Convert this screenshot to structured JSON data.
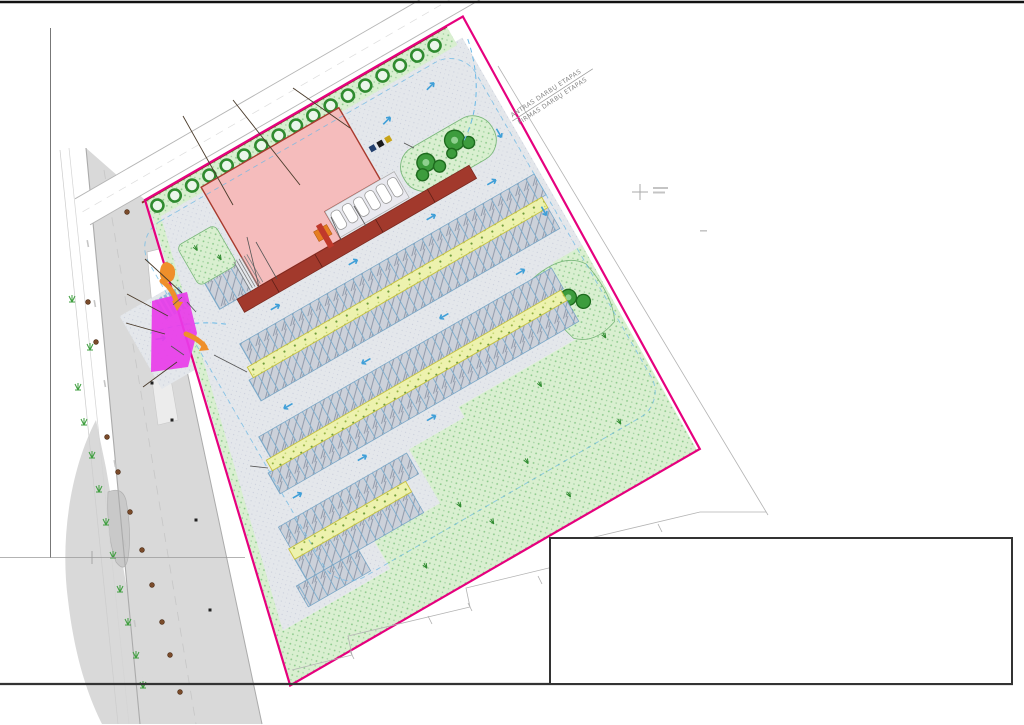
{
  "drawing": {
    "kind": "parking-lot site plan",
    "stage_boundary": {
      "line1": "ANTRAS DARBŲ ETAPAS",
      "line2": "PIRMAS DARBŲ ETAPAS"
    }
  },
  "colors": {
    "boundary": "#e6007e",
    "magenta_area": "#e93ce9",
    "building": "#f5bcbc",
    "building_stroke": "#a83a2e",
    "walkway": "#a2392c",
    "paving": "#e4e7eb",
    "green": "#d9efd0",
    "yellow_strip": "#edf2ae",
    "arrow_orange": "#ef8f2a",
    "flow_blue": "#3f9fd8",
    "sign_red": "#8b1616",
    "sign_blue": "#1a56c0",
    "tree_green": "#3d9c3d"
  },
  "parking_letter": "P",
  "sign_columns": [
    {
      "x": 183,
      "y": 38,
      "items": [
        {
          "kind": "parking",
          "code": "828"
        },
        {
          "kind": "car",
          "code": "836"
        },
        {
          "kind": "arrows",
          "code": "814"
        }
      ]
    },
    {
      "x": 233,
      "y": 24,
      "items": [
        {
          "kind": "parking",
          "code": "828"
        },
        {
          "kind": "accessible",
          "code": "846"
        },
        {
          "kind": "arrows",
          "code": "814"
        }
      ]
    },
    {
      "x": 293,
      "y": 28,
      "items": [
        {
          "kind": "code",
          "code": "828"
        },
        {
          "kind": "car",
          "code": "854"
        },
        {
          "kind": "arrows",
          "code": "814"
        }
      ]
    }
  ],
  "left_signs": [
    {
      "kind": "crossing",
      "code": "533",
      "x": 136,
      "y": 249
    },
    {
      "kind": "yield",
      "code": "",
      "x": 116,
      "y": 282
    },
    {
      "kind": "crossing",
      "code": "533",
      "x": 117,
      "y": 313
    },
    {
      "kind": "crossing",
      "code": "533",
      "x": 135,
      "y": 381
    }
  ],
  "callouts": [
    {
      "n": "10",
      "x": 303,
      "y": 171
    },
    {
      "n": "1",
      "x": 395,
      "y": 258
    },
    {
      "n": "2",
      "x": 432,
      "y": 371
    },
    {
      "n": "3",
      "x": 277,
      "y": 279
    },
    {
      "n": "8",
      "x": 259,
      "y": 287
    },
    {
      "n": "4",
      "x": 341,
      "y": 240
    },
    {
      "n": "5",
      "x": 366,
      "y": 226
    },
    {
      "n": "6",
      "x": 404,
      "y": 143
    },
    {
      "n": "9",
      "x": 207,
      "y": 258
    },
    {
      "n": "13",
      "x": 173,
      "y": 305
    },
    {
      "n": "14",
      "x": 196,
      "y": 312
    },
    {
      "n": "12",
      "x": 184,
      "y": 355
    },
    {
      "n": "11",
      "x": 214,
      "y": 355
    },
    {
      "n": "11",
      "x": 250,
      "y": 466
    }
  ]
}
